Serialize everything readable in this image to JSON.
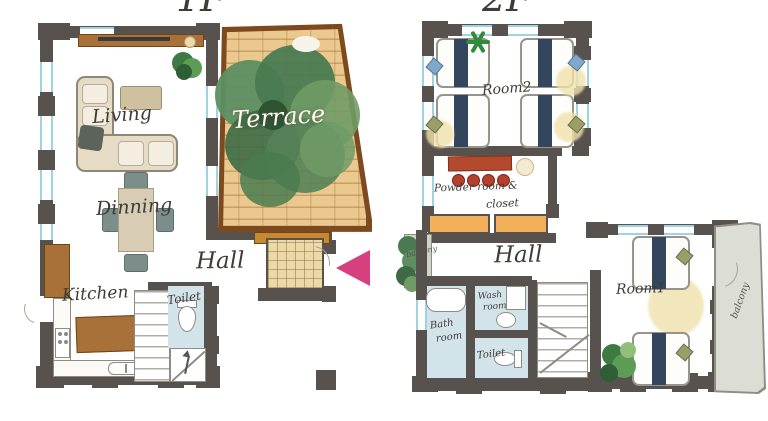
{
  "titles": {
    "floor1": "1F",
    "floor2": "2F"
  },
  "floor1": {
    "living": "Living",
    "terrace": "Terrace",
    "dining": "Dinning",
    "hall": "Hall",
    "kitchen": "Kitchen",
    "toilet": "Toilet"
  },
  "floor2": {
    "room2": "Room2",
    "powder_line1": "Powder room &",
    "powder_line2": "closet",
    "hall": "Hall",
    "bath_line1": "Bath",
    "bath_line2": "room",
    "wash_line1": "Wash",
    "wash_line2": "room",
    "toilet": "Toilet",
    "room1": "Room1",
    "balcony_small": "balcony",
    "balcony_right": "balcony"
  },
  "icons": {
    "entrance_arrow": "left-pointing-triangle"
  },
  "colors": {
    "wall": "#57524d",
    "window_blue": "#9fd3e4",
    "brick": "#eac88e",
    "terrace_border": "#7c4a1e",
    "wood": "#a9713a",
    "bed_navy": "#33465e",
    "bath_blue": "#d2e4e9",
    "counter_red": "#b34a2e",
    "arrow_pink": "#d6407e",
    "rug_yellow": "#f0e2ac",
    "plant_green": "#4c7e4f",
    "balcony_gray": "#dcddd5"
  }
}
